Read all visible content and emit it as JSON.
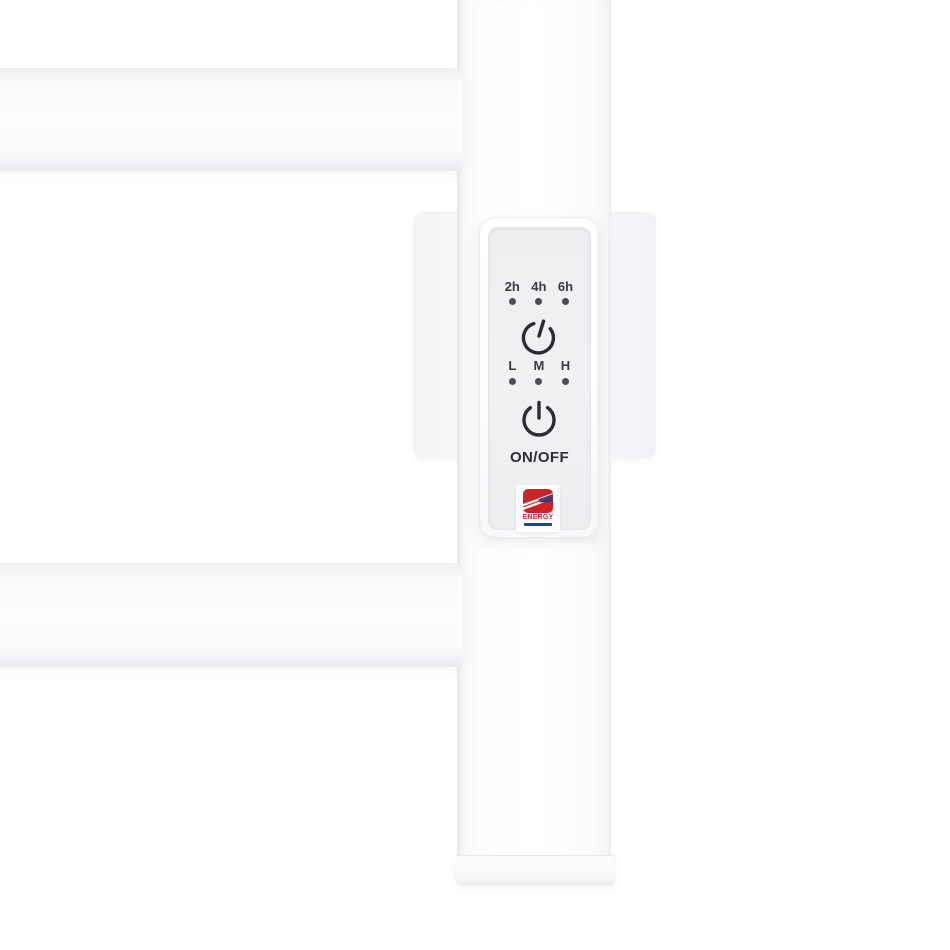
{
  "control_panel": {
    "timer": {
      "labels": [
        "2h",
        "4h",
        "6h"
      ]
    },
    "heat": {
      "labels": [
        "L",
        "M",
        "H"
      ]
    },
    "on_off_label": "ON/OFF",
    "logo": {
      "text": "ENERGY"
    },
    "icons": {
      "timer_button": "power-timer-icon",
      "power_button": "power-icon"
    },
    "colors": {
      "panel_face": "#f0f0f2",
      "icon_dark": "#2c2c31",
      "indicator_dot": "#4d4d53",
      "logo_red": "#cd2328",
      "logo_blue": "#21418e"
    }
  }
}
